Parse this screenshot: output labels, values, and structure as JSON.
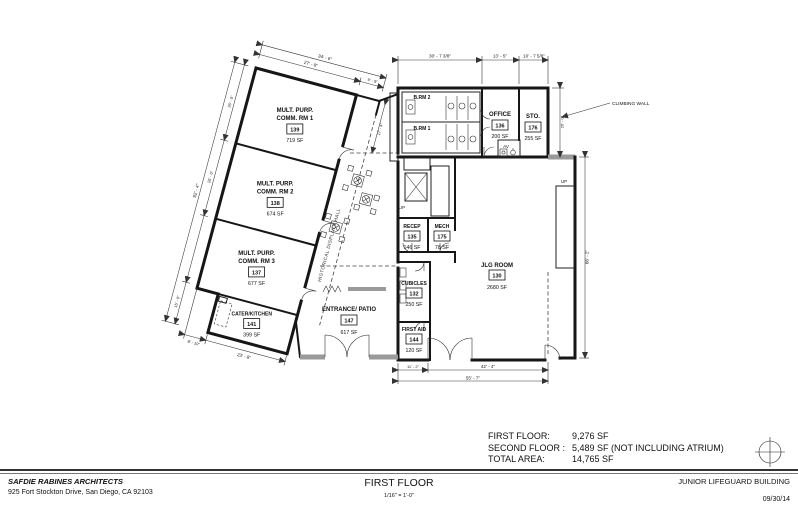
{
  "plan": {
    "rooms": {
      "mp1": {
        "line1": "MULT. PURP.",
        "line2": "COMM. RM 1",
        "number": "139",
        "area": "719 SF"
      },
      "mp2": {
        "line1": "MULT. PURP.",
        "line2": "COMM. RM 2",
        "number": "138",
        "area": "674 SF"
      },
      "mp3": {
        "line1": "MULT. PURP.",
        "line2": "COMM. RM 3",
        "number": "137",
        "area": "677 SF"
      },
      "kitchen": {
        "name": "CATER/KITCHEN",
        "number": "141",
        "area": "399 SF"
      },
      "entrance": {
        "name": "ENTRANCE/ PATIO",
        "number": "147",
        "area": "617 SF"
      },
      "office": {
        "name": "OFFICE",
        "number": "136",
        "area": "200 SF"
      },
      "storage": {
        "name": "STO.",
        "number": "176",
        "area": "255 SF"
      },
      "recep": {
        "name": "RECEP",
        "number": "135",
        "area": "146 SF"
      },
      "mech": {
        "name": "MECH",
        "number": "175",
        "area": "78 SF"
      },
      "cubicles": {
        "name": "CUBICLES",
        "number": "132",
        "area": "250 SF"
      },
      "first_aid": {
        "name": "FIRST AID",
        "number": "144",
        "area": "120 SF"
      },
      "jlg": {
        "name": "JLG ROOM",
        "number": "130",
        "area": "2680 SF"
      },
      "brm1": {
        "name": "B.RM 1"
      },
      "brm2": {
        "name": "B.RM 2"
      },
      "av": {
        "name": "AV"
      }
    },
    "labels": {
      "climbing_wall": "CLIMBING WALL",
      "hall": "HISTORICAL DISPLAYS HALL",
      "up_atrium": "UP",
      "up_east": "UP"
    },
    "dims": {
      "top1": "30' - 7 3/8\"",
      "top2": "13' - 5\"",
      "top3": "10' - 7 5/8\"",
      "east_upper": "26' - 0\"",
      "east_main": "66' - 2\"",
      "bottom1": "11' - 2\"",
      "bottom2": "42' - 4\"",
      "bottom_total": "55' - 7\"",
      "wing_top_outer": "34' - 6\"",
      "wing_top_inner": "27' - 8\"",
      "wing_corridor": "6' - 9\"",
      "wing_left_total": "92' - 4\"",
      "wing_seg1": "26' - 0\"",
      "wing_seg2": "26' - 0\"",
      "wing_gap": "17' - 4\"",
      "kitchen_left": "15' - 0\"",
      "kitchen_jog": "8' - 10\"",
      "kitchen_bottom": "23' - 8\""
    }
  },
  "summary": {
    "rows": [
      {
        "label": "FIRST FLOOR:",
        "value": "9,276 SF"
      },
      {
        "label": "SECOND FLOOR :",
        "value": "5,489 SF (NOT INCLUDING ATRIUM)"
      },
      {
        "label": "TOTAL  AREA:",
        "value": "14,765 SF"
      }
    ]
  },
  "title_block": {
    "firm_name": "SAFDIE RABINES ARCHITECTS",
    "firm_address": "925 Fort Stockton Drive, San Diego, CA 92103",
    "sheet_title": "FIRST FLOOR",
    "scale": "1/16\" = 1'-0\"",
    "project": "JUNIOR LIFEGUARD BUILDING",
    "date": "09/30/14"
  }
}
